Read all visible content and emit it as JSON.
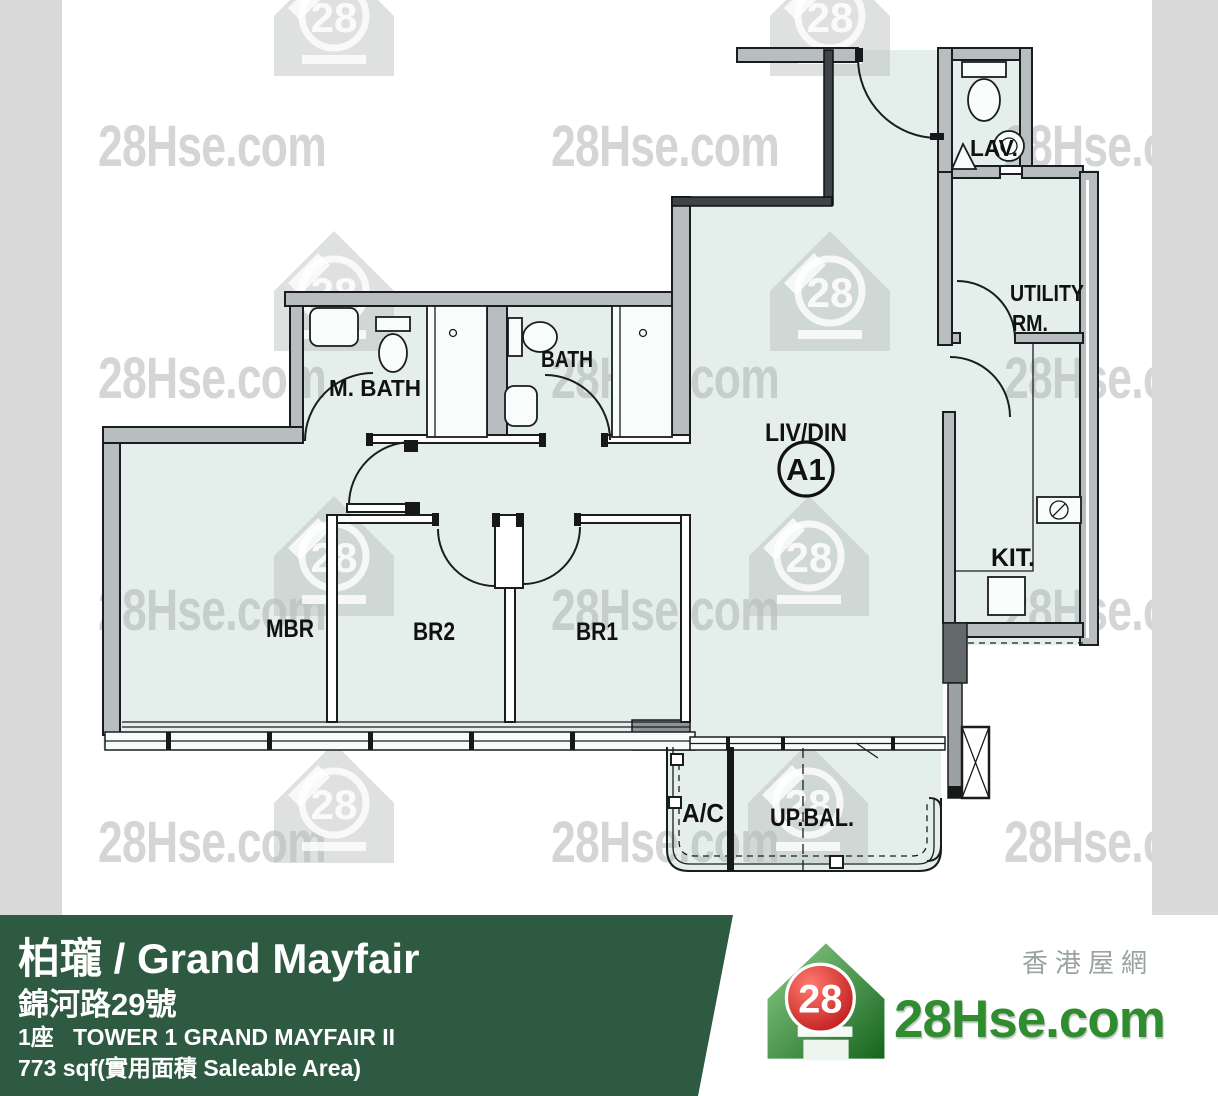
{
  "plan": {
    "unit_label": "A1",
    "rooms": {
      "living": "LIV/DIN",
      "master_bath": "M. BATH",
      "bath": "BATH",
      "lavatory": "LAV.",
      "utility_line1": "UTILITY",
      "utility_line2": "RM.",
      "kitchen": "KIT.",
      "master_bedroom": "MBR",
      "bedroom2": "BR2",
      "bedroom1": "BR1",
      "ac_platform": "A/C",
      "balcony": "UP.BAL."
    }
  },
  "watermark": {
    "text": "28Hse.com",
    "badge": "28"
  },
  "footer": {
    "title": "柏瓏 / Grand Mayfair",
    "address": "錦河路29號",
    "tower": "1座   TOWER 1 GRAND MAYFAIR II",
    "area": "773 sqf(實用面積 Saleable Area)",
    "brand": {
      "badge": "28",
      "name": "28Hse.com",
      "tagline": "香港屋網"
    }
  },
  "colors": {
    "floor": "#e4efec",
    "wall_gray": "#b8bdbf",
    "line_black": "#1a1d1f",
    "watermark_gray": "#d4d6d5",
    "side_strip": "#dadada",
    "footer_green": "#2d5a41",
    "brand_green": "#2f8c2f",
    "brand_red": "#cc1418",
    "tagline_gray": "#9aa2a2"
  }
}
